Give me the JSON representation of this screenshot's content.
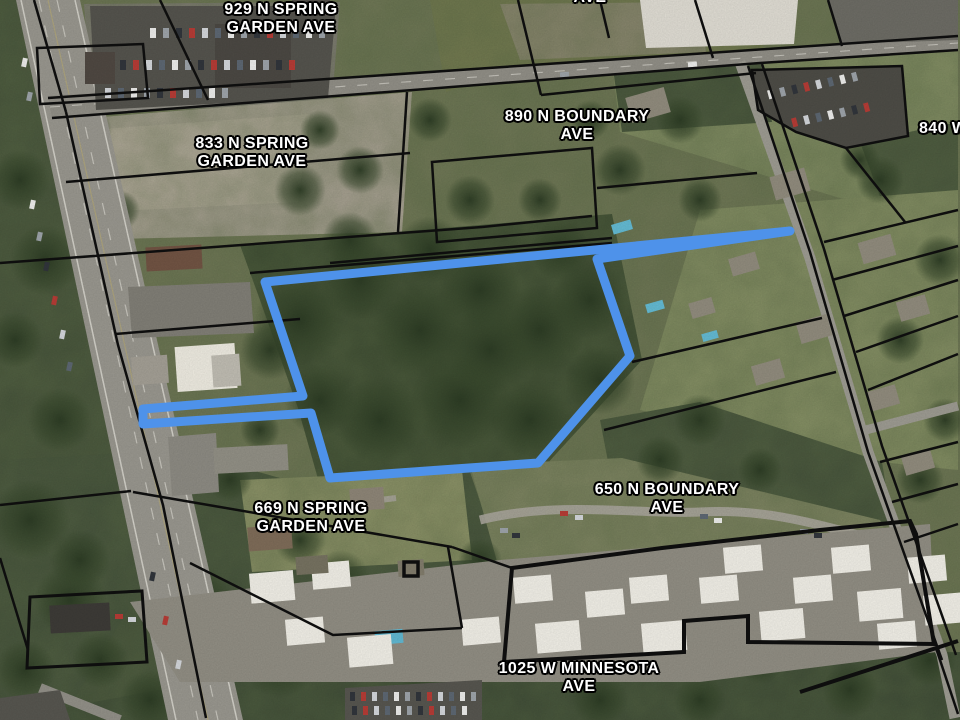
{
  "map": {
    "description": "Oblique aerial parcel map with highlighted property outline",
    "highlight": {
      "name": "selected-parcel",
      "color": "#4e92ea",
      "stroke_width": 9
    },
    "parcel_line_color": "#0e0e0e",
    "label_style": {
      "color": "#ffffff",
      "outline": "#000000"
    },
    "labels": [
      {
        "id": "label-929",
        "lines": [
          "929 N SPRING",
          "GARDEN AVE"
        ]
      },
      {
        "id": "label-ave-top",
        "lines": [
          "AVE"
        ]
      },
      {
        "id": "label-833",
        "lines": [
          "833 N SPRING",
          "GARDEN AVE"
        ]
      },
      {
        "id": "label-890",
        "lines": [
          "890 N BOUNDARY",
          "AVE"
        ]
      },
      {
        "id": "label-840",
        "lines": [
          "840 W"
        ]
      },
      {
        "id": "label-669",
        "lines": [
          "669 N SPRING",
          "GARDEN AVE"
        ]
      },
      {
        "id": "label-650",
        "lines": [
          "650 N BOUNDARY",
          "AVE"
        ]
      },
      {
        "id": "label-1025",
        "lines": [
          "1025 W MINNESOTA",
          "AVE"
        ]
      }
    ]
  }
}
